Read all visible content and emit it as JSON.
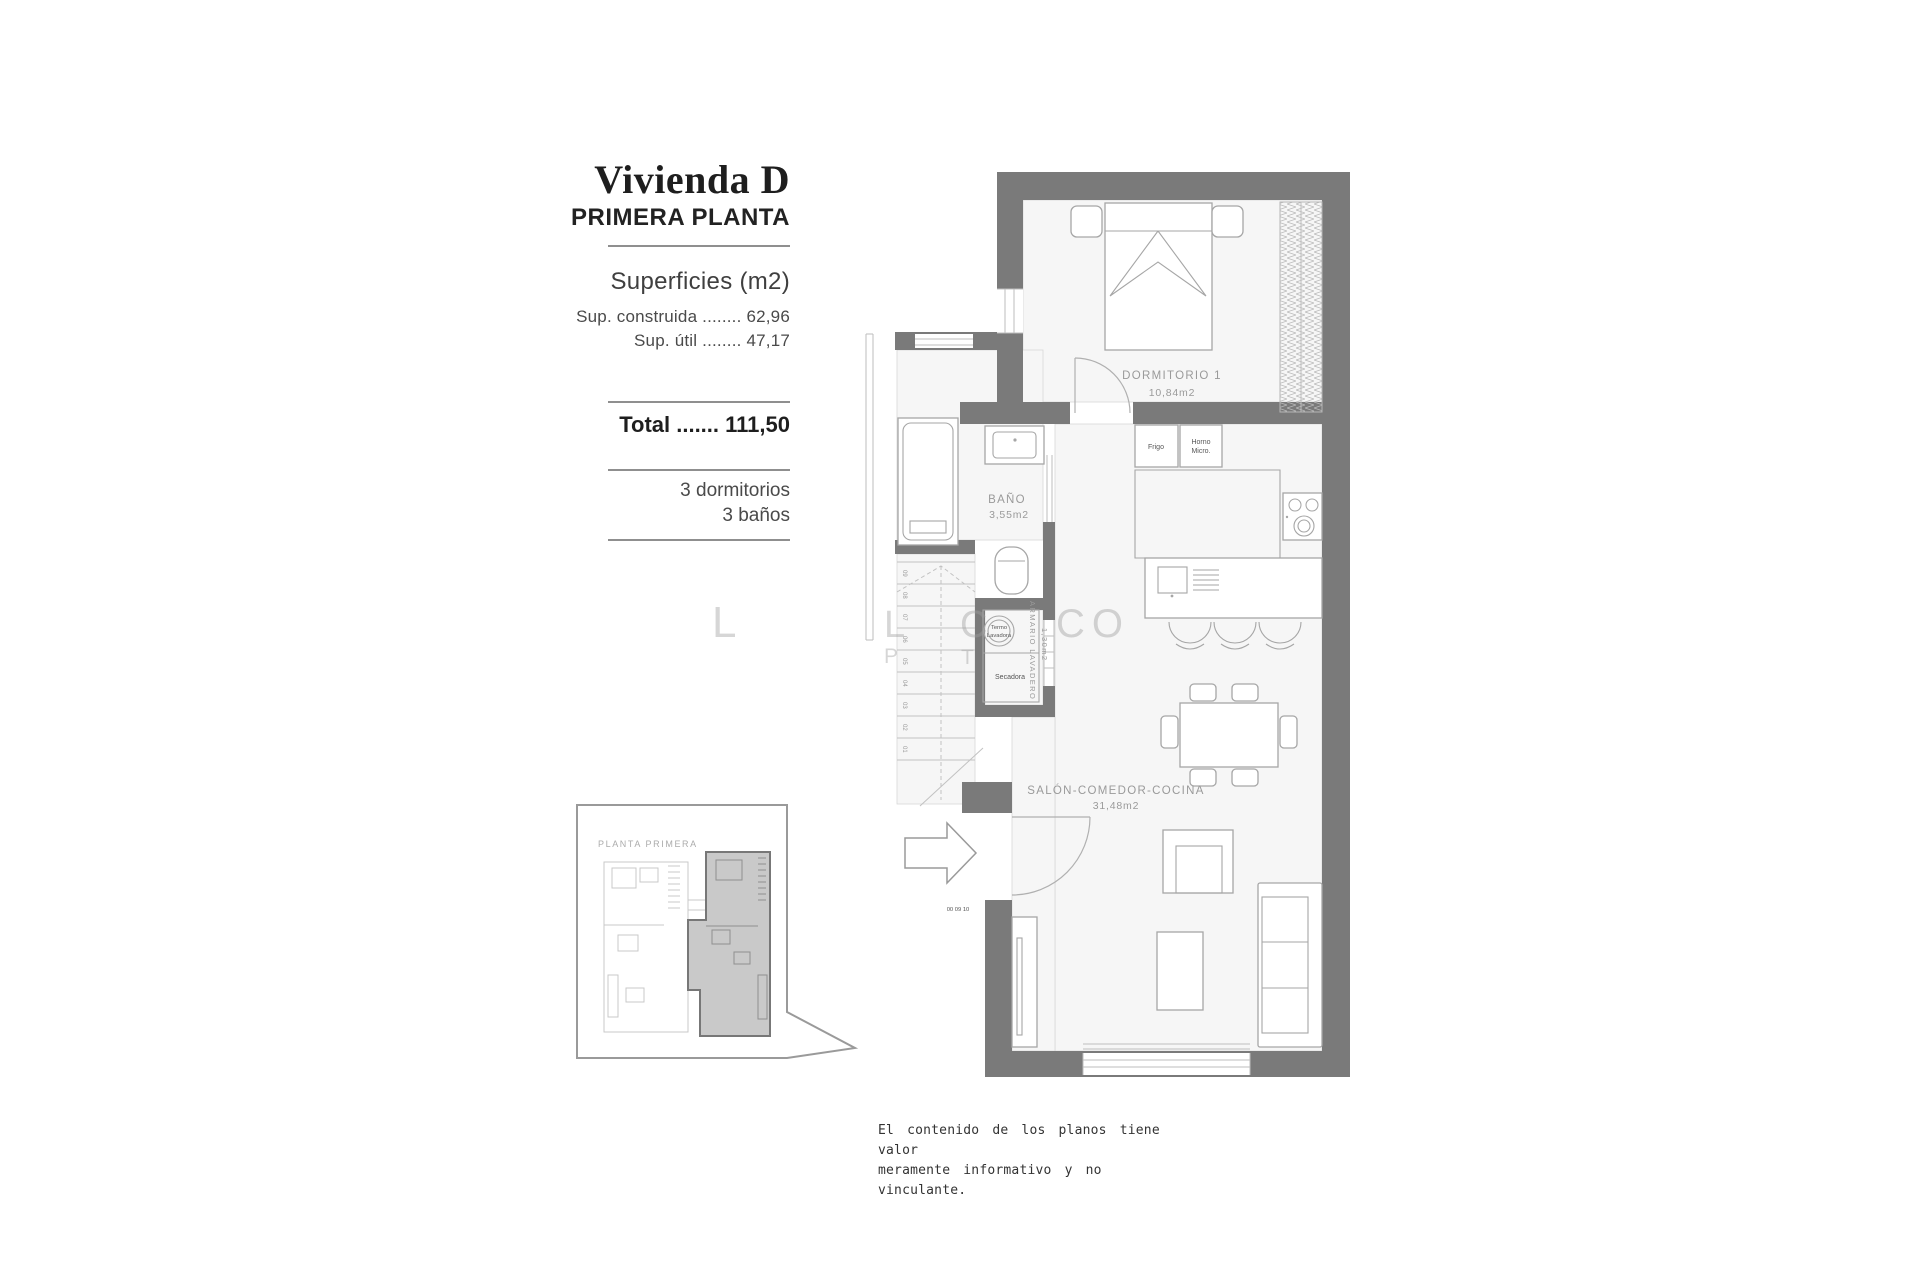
{
  "info": {
    "title": "Vivienda D",
    "subtitle": "PRIMERA PLANTA",
    "surfaces_heading": "Superficies (m2)",
    "rows": [
      "Sup. construida ........ 62,96",
      "Sup. útil ........ 47,17"
    ],
    "total_row": "Total ....... 111,50",
    "features": [
      "3 dormitorios",
      "3 baños"
    ]
  },
  "overview": {
    "label": "PLANTA PRIMERA"
  },
  "plan": {
    "rooms": [
      {
        "name": "DORMITORIO 1",
        "area": "10,84m2"
      },
      {
        "name": "BAÑO",
        "area": "3,55m2"
      },
      {
        "name": "SALÓN-COMEDOR-COCINA",
        "area": "31,48m2"
      },
      {
        "name": "ARMARIO LAVADERO",
        "area": "1,30m2"
      }
    ],
    "appliances": {
      "fridge": "Frigo",
      "oven_line1": "Horno",
      "oven_line2": "Micro.",
      "washer_line1": "Termo",
      "washer_line2": "Lavadora",
      "dryer": "Secadora"
    },
    "stairs": {
      "steps": [
        "09",
        "08",
        "07",
        "06",
        "05",
        "04",
        "03",
        "02",
        "01"
      ],
      "bottom_marks": "00  09  10"
    }
  },
  "watermark": {
    "fragments": [
      "L",
      "L",
      "C",
      "CO",
      "P",
      "T"
    ]
  },
  "disclaimer": {
    "line1": "El contenido de los planos tiene valor",
    "line2": "meramente informativo y no vinculante."
  },
  "colors": {
    "wall": "#7a7a7a",
    "unit_highlight": "#c9c9c9",
    "furniture_line": "#a6a6a6",
    "room_label": "#9a9a9a"
  }
}
